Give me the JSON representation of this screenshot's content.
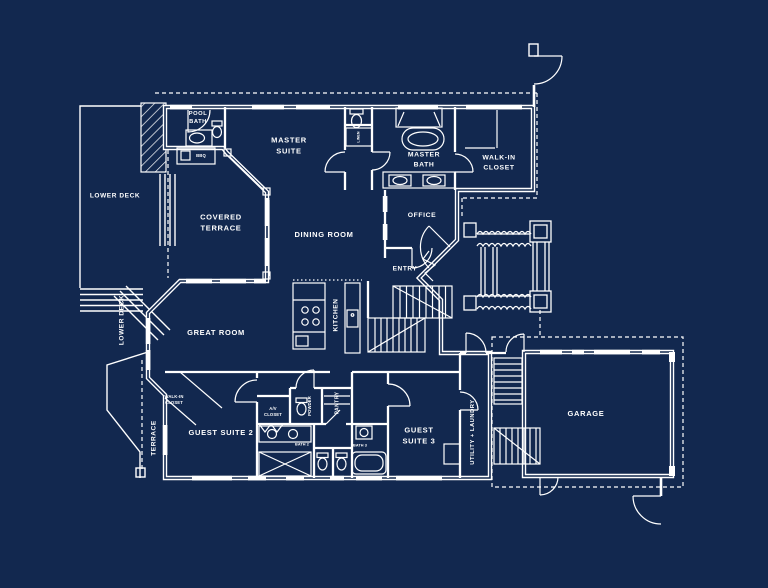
{
  "palette": {
    "background": "#12284f",
    "line_color": "#ffffff",
    "text_color": "#ffffff"
  },
  "labels": {
    "pool_bath": "POOL\nBATH",
    "bbq": "BBQ",
    "master_suite": "MASTER\nSUITE",
    "master_bath": "MASTER\nBATH",
    "linen": "LINEN",
    "walk_in_closet": "WALK-IN\nCLOSET",
    "lower_deck_upper": "LOWER DECK",
    "lower_deck_side": "LOWER DECK",
    "covered_terrace": "COVERED\nTERRACE",
    "dining_room": "DINING ROOM",
    "office": "OFFICE",
    "entry": "ENTRY",
    "great_room": "GREAT ROOM",
    "kitchen": "KITCHEN",
    "terrace": "TERRACE",
    "guest2_closet": "WALK-IN\nCLOSET",
    "guest_suite_2": "GUEST SUITE 2",
    "av_closet": "A/V\nCLOSET",
    "powder": "POWDER",
    "pantry": "PANTRY",
    "bath_2": "BATH 2",
    "bath_3": "BATH 3",
    "guest_suite_3": "GUEST\nSUITE 3",
    "utility_laundry": "UTILITY + LAUNDRY",
    "garage": "GARAGE"
  }
}
